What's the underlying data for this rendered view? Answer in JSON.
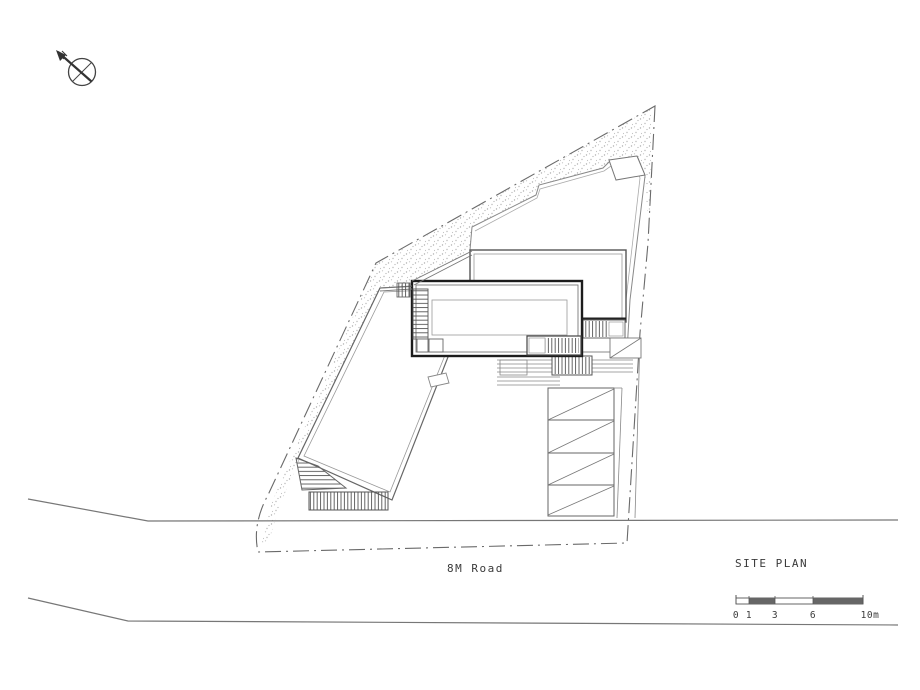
{
  "drawing": {
    "title": "SITE PLAN",
    "road_label": "8M Road",
    "scale_bar": {
      "labels": [
        "0",
        "1",
        "3",
        "6",
        "10m"
      ]
    },
    "colors": {
      "line_dark": "#1c1c1c",
      "line_mid": "#555555",
      "line_light": "#999999",
      "stipple": "#b0b0b0",
      "background": "#ffffff"
    }
  }
}
